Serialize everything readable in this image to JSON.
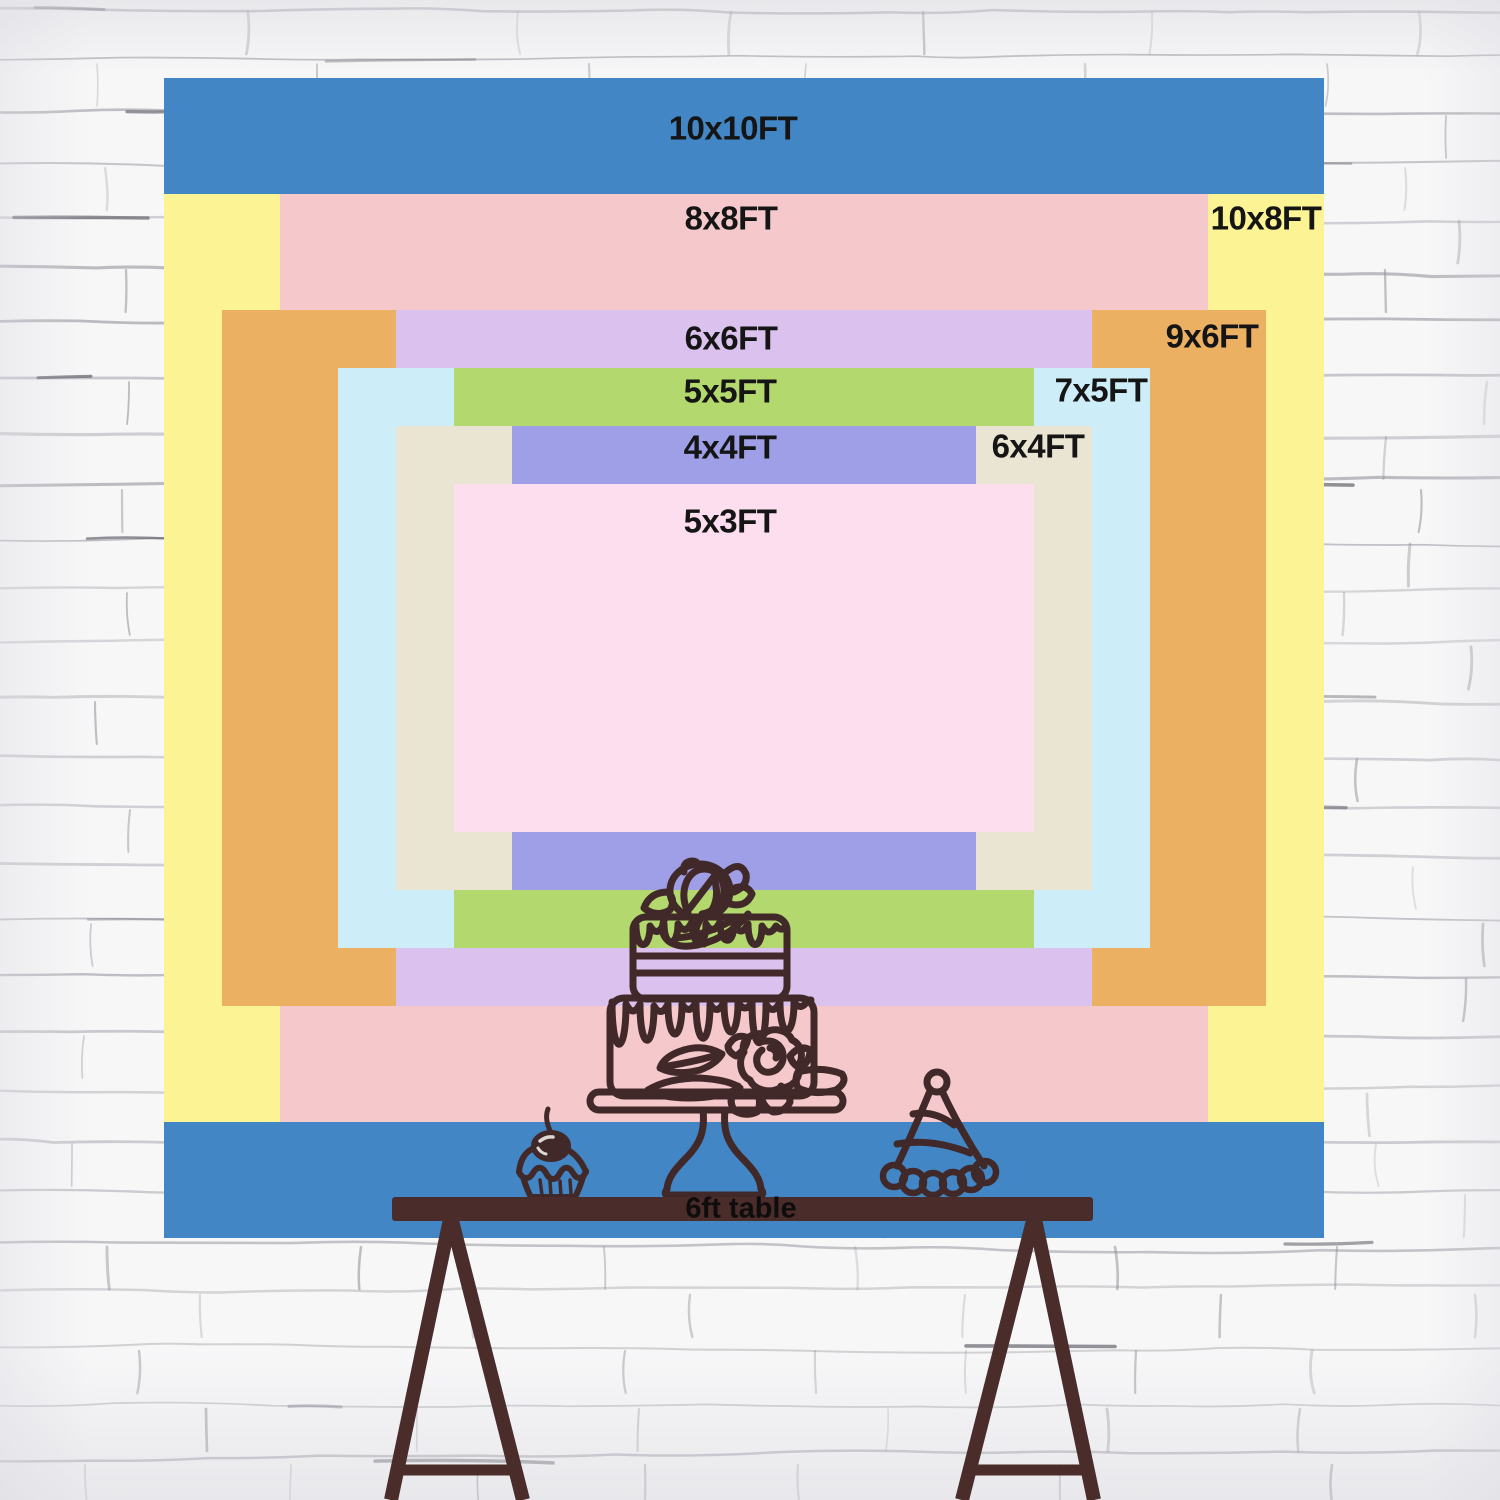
{
  "chart_title": "Backdrop size comparison",
  "sizes": [
    {
      "id": "10x10ft",
      "label": "10x10FT",
      "width_ft": 10,
      "height_ft": 10,
      "color": "#4286c5"
    },
    {
      "id": "10x8ft",
      "label": "10x8FT",
      "width_ft": 10,
      "height_ft": 8,
      "color": "#fcf494"
    },
    {
      "id": "8x8ft",
      "label": "8x8FT",
      "width_ft": 8,
      "height_ft": 8,
      "color": "#f5c9cc"
    },
    {
      "id": "9x6ft",
      "label": "9x6FT",
      "width_ft": 9,
      "height_ft": 6,
      "color": "#ebb062"
    },
    {
      "id": "6x6ft",
      "label": "6x6FT",
      "width_ft": 6,
      "height_ft": 6,
      "color": "#dbc1ee"
    },
    {
      "id": "7x5ft",
      "label": "7x5FT",
      "width_ft": 7,
      "height_ft": 5,
      "color": "#cdedf8"
    },
    {
      "id": "5x5ft",
      "label": "5x5FT",
      "width_ft": 5,
      "height_ft": 5,
      "color": "#b3d86d"
    },
    {
      "id": "6x4ft",
      "label": "6x4FT",
      "width_ft": 6,
      "height_ft": 4,
      "color": "#eae4d3"
    },
    {
      "id": "4x4ft",
      "label": "4x4FT",
      "width_ft": 4,
      "height_ft": 4,
      "color": "#9f9fe8"
    },
    {
      "id": "5x3ft",
      "label": "5x3FT",
      "width_ft": 5,
      "height_ft": 3,
      "color": "#fcdeee"
    }
  ],
  "table": {
    "label": "6ft table",
    "length_ft": 6,
    "color": "#4a2d2a"
  },
  "artwork": {
    "line_color": "#41292a",
    "items": [
      "tiered-cake",
      "cupcake",
      "party-hat",
      "trestle-table"
    ]
  }
}
